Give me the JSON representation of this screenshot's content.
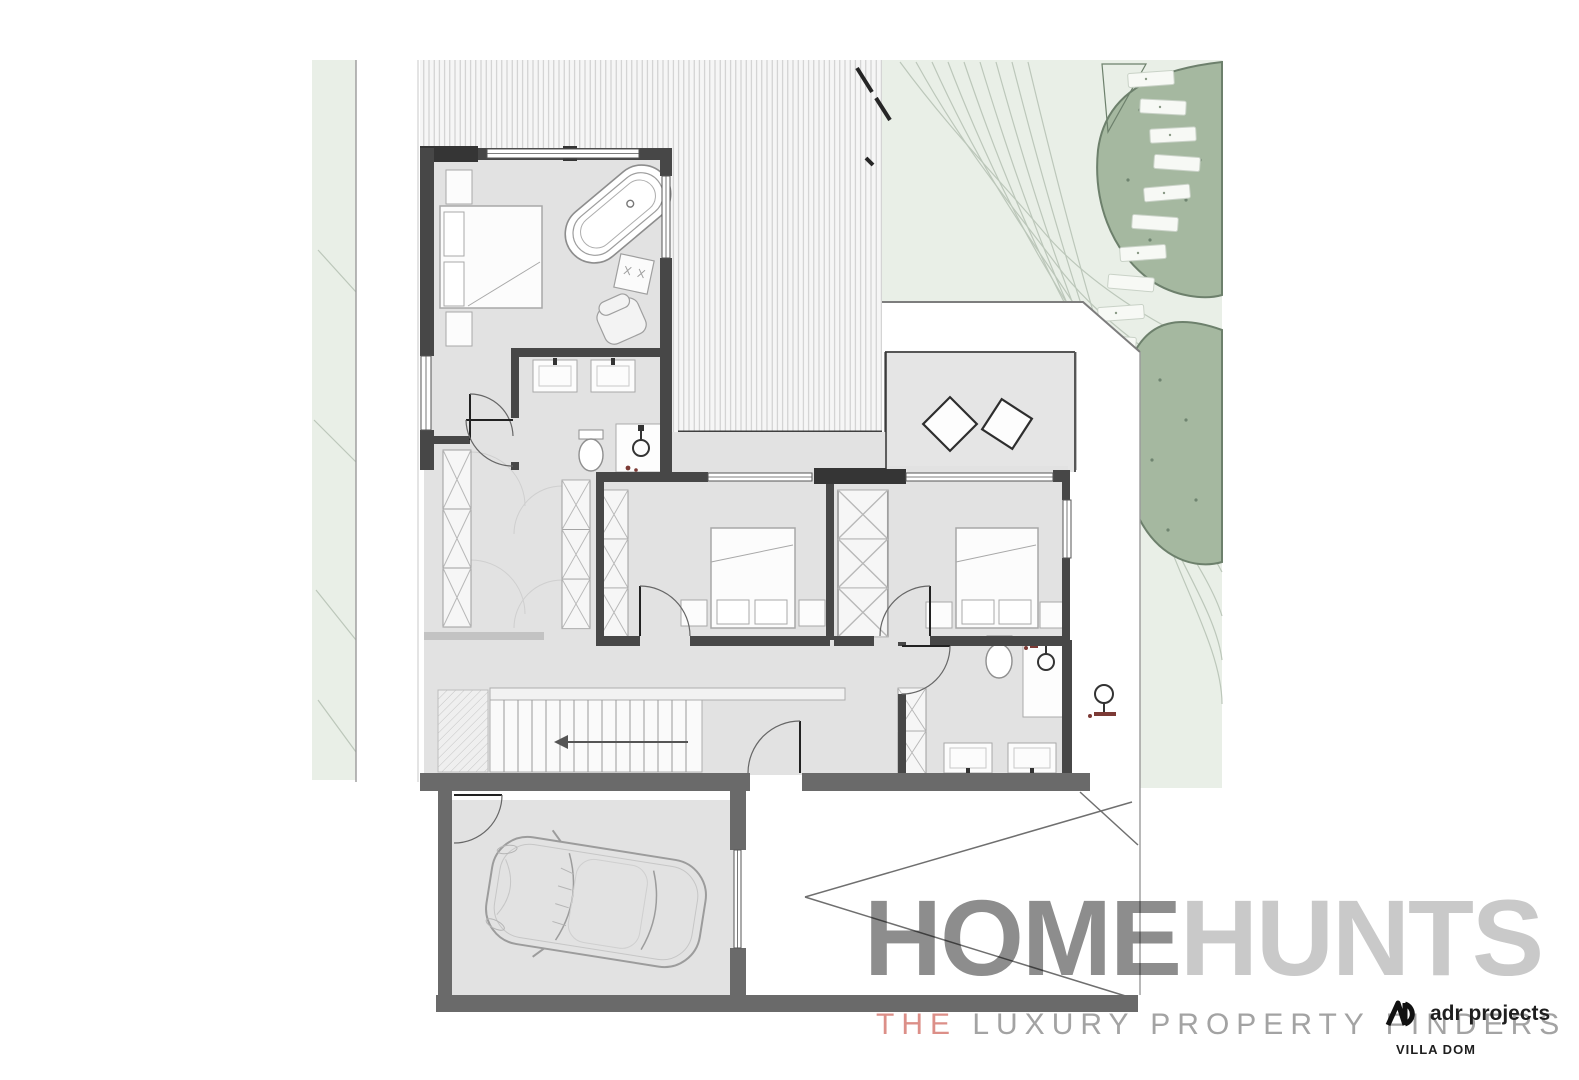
{
  "branding": {
    "watermark_primary": "HOME",
    "watermark_secondary": "HUNTS",
    "tagline_highlight": "THE",
    "tagline_rest": " LUXURY PROPERTY FINDERS",
    "studio_monogram": "AD",
    "studio_name": "adr projects",
    "project_name": "VILLA DOM"
  },
  "plan": {
    "type": "architectural floor plan, upper level with garage and landscaped site",
    "icons": {
      "stairs_direction_arrow": "←",
      "shower_head": "circle with stem",
      "wardrobe_cell": "rectangle with X",
      "tree_canopy": "green blob",
      "stone_step": "small dotted slab"
    }
  },
  "colors": {
    "page_bg": "#ffffff",
    "lawn": "#e9efe7",
    "lawn_line": "#bcc7ba",
    "tree_fill": "#a5b8a0",
    "tree_line": "#6d806c",
    "step_fill": "#f7f9f5",
    "step_line": "#c9d2c7",
    "room_fill": "#e2e2e2",
    "terrace_fill": "#e5e5e5",
    "roof_bg": "#f6f6f6",
    "roof_line": "#c9c9c9",
    "wall": "#474747",
    "wall_heavy": "#6a6a6a",
    "wall_darker": "#353535",
    "line": "#3c3c3c",
    "door_line": "#222222",
    "swing_line": "#cfcfcf",
    "furn_fill": "#fcfcfc",
    "furn_line": "#a8a8a8",
    "tread_line": "#9a9a9a",
    "fixture_accent": "#7c3a35",
    "watermark_primary": "#8d8d8d",
    "watermark_secondary": "#c9c9c9",
    "tagline_text": "#a3a3a3",
    "tagline_accent": "#dc8f88",
    "brand_ink": "#1e1e1e"
  }
}
